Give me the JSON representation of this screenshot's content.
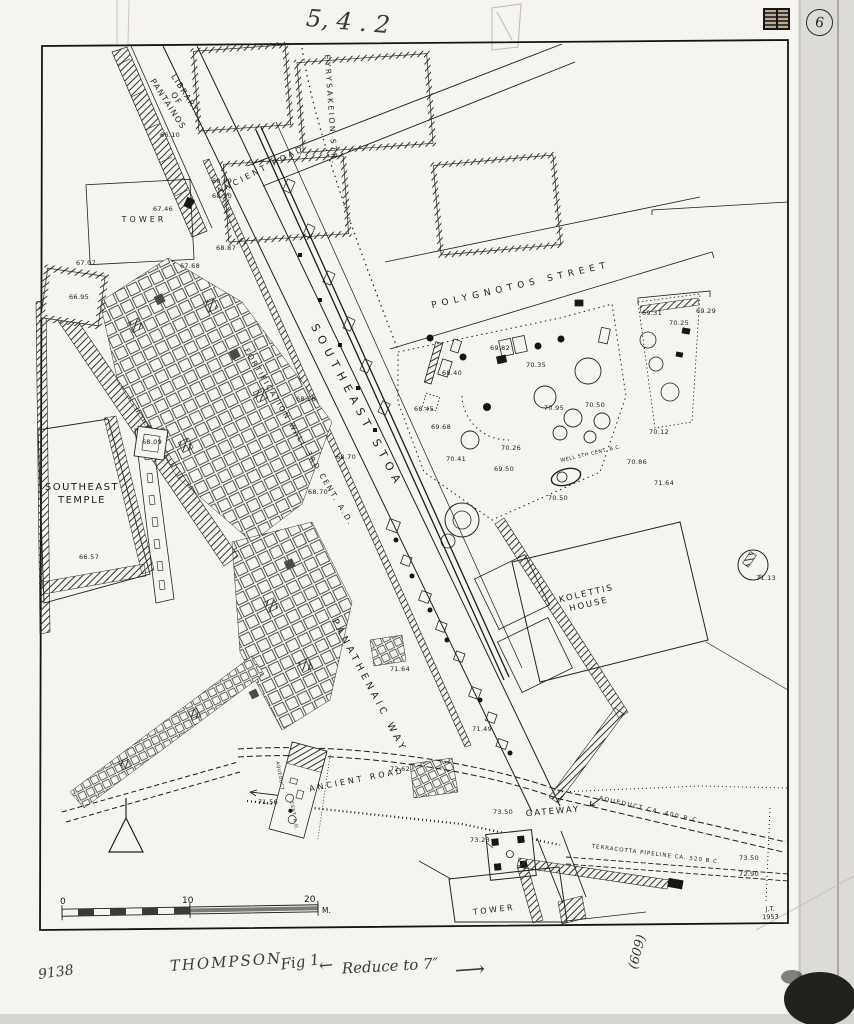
{
  "annotations": {
    "circled_number": "6",
    "stamp": "inked-stamp-block",
    "handwriting": [
      {
        "t": "5, 4 . 2",
        "x": 348,
        "y": 22,
        "r": 5,
        "s": 24
      },
      {
        "t": "THOMPSON",
        "x": 226,
        "y": 962,
        "r": -4,
        "s": 15,
        "sp": 2
      },
      {
        "t": "Fig 1",
        "x": 300,
        "y": 962,
        "r": -8,
        "s": 15
      },
      {
        "t": "←",
        "x": 326,
        "y": 966,
        "r": -5,
        "s": 17
      },
      {
        "t": "Reduce to 7″",
        "x": 390,
        "y": 966,
        "r": -3,
        "s": 15
      },
      {
        "t": "⟶",
        "x": 470,
        "y": 970,
        "r": -4,
        "s": 21
      },
      {
        "t": "(609)",
        "x": 638,
        "y": 952,
        "r": -75,
        "s": 13
      },
      {
        "t": "9138",
        "x": 56,
        "y": 973,
        "r": -8,
        "s": 14
      }
    ]
  },
  "map": {
    "credit": {
      "line1": "J.T.",
      "line2": "1953"
    },
    "scale": {
      "zero": "0",
      "ten": "10",
      "twenty": "20",
      "unit": "M."
    },
    "streets": [
      {
        "t": "LIBRARY\nOF\nPANTAINOS",
        "x": 176,
        "y": 99,
        "r": 57,
        "s": 8,
        "sp": 1.5,
        "lh": 1.25
      },
      {
        "t": "ANCIENT ROAD",
        "x": 261,
        "y": 170,
        "r": -27,
        "s": 8,
        "sp": 3
      },
      {
        "t": "EYRYSAKEION STR.",
        "x": 331,
        "y": 110,
        "r": 86,
        "s": 7.5,
        "sp": 2.5
      },
      {
        "t": "TOWER",
        "x": 144,
        "y": 220,
        "r": 0,
        "s": 8,
        "sp": 3
      },
      {
        "t": "POLYGNOTOS STREET",
        "x": 521,
        "y": 286,
        "r": -13,
        "s": 9,
        "sp": 5
      },
      {
        "t": "SOUTHEAST\nTEMPLE",
        "x": 82,
        "y": 494,
        "r": 0,
        "s": 10,
        "sp": 1.5,
        "lh": 1.3
      },
      {
        "t": "FORTIFICATION WALL 3RD CENT. A.D.",
        "x": 299,
        "y": 437,
        "r": 59,
        "s": 7.5,
        "sp": 2
      },
      {
        "t": "SOUTHEAST STOA",
        "x": 357,
        "y": 406,
        "r": 62,
        "s": 11,
        "sp": 6
      },
      {
        "t": "KOLETTIS\nHOUSE",
        "x": 588,
        "y": 600,
        "r": -13,
        "s": 8.5,
        "sp": 2,
        "lh": 1.3
      },
      {
        "t": "PANATHENAIC WAY",
        "x": 369,
        "y": 686,
        "r": 62,
        "s": 9.5,
        "sp": 4
      },
      {
        "t": "ANCIENT ROAD",
        "x": 357,
        "y": 780,
        "r": -11,
        "s": 8,
        "sp": 3
      },
      {
        "t": "GATEWAY",
        "x": 553,
        "y": 812,
        "r": -5,
        "s": 8.5,
        "sp": 2
      },
      {
        "t": "AQUEDUCT CA. 400 B.C.",
        "x": 650,
        "y": 810,
        "r": 13,
        "s": 6,
        "sp": 1.5
      },
      {
        "t": "TERRACOTTA PIPELINE CA. 520 B.C.",
        "x": 656,
        "y": 855,
        "r": 7,
        "s": 5.5,
        "sp": 1
      },
      {
        "t": "WELL 5TH CENT. B.C.",
        "x": 591,
        "y": 454,
        "r": -13,
        "s": 5,
        "sp": 0.5
      },
      {
        "t": "TOWER",
        "x": 494,
        "y": 910,
        "r": -7,
        "s": 8,
        "sp": 2.5
      },
      {
        "t": "AQUEDUCT",
        "x": 279,
        "y": 776,
        "r": 80,
        "s": 4.5,
        "sp": 0.5
      },
      {
        "t": "CENT. A.D.",
        "x": 293,
        "y": 816,
        "r": 80,
        "s": 4.5,
        "sp": 0.5
      }
    ],
    "elevations": [
      {
        "v": "66.10",
        "x": 170,
        "y": 136
      },
      {
        "v": "68.09",
        "x": 222,
        "y": 182
      },
      {
        "v": "68.50",
        "x": 222,
        "y": 197
      },
      {
        "v": "67.46",
        "x": 163,
        "y": 210
      },
      {
        "v": "68.87",
        "x": 226,
        "y": 249
      },
      {
        "v": "67.07",
        "x": 86,
        "y": 264
      },
      {
        "v": "67.68",
        "x": 190,
        "y": 267
      },
      {
        "v": "66.95",
        "x": 79,
        "y": 298
      },
      {
        "v": "69.31",
        "x": 652,
        "y": 314
      },
      {
        "v": "69.29",
        "x": 706,
        "y": 312
      },
      {
        "v": "70.25",
        "x": 679,
        "y": 324
      },
      {
        "v": "69.82",
        "x": 500,
        "y": 349
      },
      {
        "v": "70.35",
        "x": 536,
        "y": 366
      },
      {
        "v": "68.40",
        "x": 452,
        "y": 374
      },
      {
        "v": "68.88",
        "x": 306,
        "y": 400
      },
      {
        "v": "70.50",
        "x": 595,
        "y": 406
      },
      {
        "v": "70.95",
        "x": 554,
        "y": 409
      },
      {
        "v": "68.45",
        "x": 424,
        "y": 410
      },
      {
        "v": "69.68",
        "x": 441,
        "y": 428
      },
      {
        "v": "70.12",
        "x": 659,
        "y": 433
      },
      {
        "v": "68.09",
        "x": 152,
        "y": 443
      },
      {
        "v": "70.26",
        "x": 511,
        "y": 449
      },
      {
        "v": "68.70",
        "x": 346,
        "y": 458
      },
      {
        "v": "70.41",
        "x": 456,
        "y": 460
      },
      {
        "v": "70.86",
        "x": 637,
        "y": 463
      },
      {
        "v": "69.50",
        "x": 504,
        "y": 470
      },
      {
        "v": "71.64",
        "x": 664,
        "y": 484
      },
      {
        "v": "68.70",
        "x": 318,
        "y": 493
      },
      {
        "v": "70.50",
        "x": 558,
        "y": 499
      },
      {
        "v": "66.57",
        "x": 89,
        "y": 558
      },
      {
        "v": "71.13",
        "x": 766,
        "y": 579
      },
      {
        "v": "71.64",
        "x": 400,
        "y": 670
      },
      {
        "v": "71.49",
        "x": 482,
        "y": 730
      },
      {
        "v": "72.62",
        "x": 400,
        "y": 770
      },
      {
        "v": "71.56",
        "x": 268,
        "y": 803
      },
      {
        "v": "73.50",
        "x": 503,
        "y": 813
      },
      {
        "v": "73.23",
        "x": 480,
        "y": 841
      },
      {
        "v": "73.50",
        "x": 749,
        "y": 859
      },
      {
        "v": "72.90",
        "x": 749,
        "y": 875
      }
    ]
  }
}
